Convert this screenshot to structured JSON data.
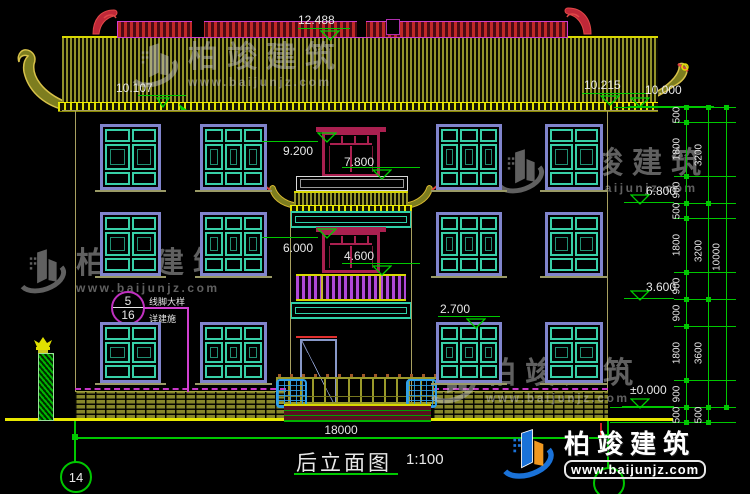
{
  "drawing": {
    "title": "后立面图",
    "scale": "1:100",
    "grid_left_label": "14",
    "bottom_dim": "18000"
  },
  "levels": {
    "ridge": "12.488",
    "left_roof": "10.107",
    "right_eave_tip": "10.215",
    "eave": "10.000",
    "tower_top_door_head": "9.200",
    "tower_top_door_sill": "7.800",
    "third_floor_window_head": "6.800",
    "tower_mid_door_head": "6.000",
    "tower_mid_door_sill": "4.600",
    "second_floor": "3.600",
    "first_floor_window_head": "2.700",
    "ground": "±0.000"
  },
  "right_dims": {
    "chain_inner": [
      "500",
      "1800",
      "900",
      "500",
      "1800",
      "900",
      "900",
      "1800",
      "900",
      "500"
    ],
    "chain_middle": [
      "3200",
      "3200",
      "3600",
      "500"
    ],
    "chain_outer": [
      "10000"
    ]
  },
  "callout": {
    "number": "5",
    "sheet": "16",
    "text_top": "线脚大样",
    "text_bottom": "详建施"
  },
  "watermark": {
    "name": "柏竣建筑",
    "url": "www.baijunjz.com"
  },
  "colors": {
    "dimension_green": "#00c800",
    "annotation_white": "#e8e8e8",
    "roof_tile_olive": "#93932a",
    "ridge_magenta": "#cf3ccf",
    "ridge_red": "#c02828",
    "window_frame_blue": "#8084cc",
    "window_teal": "#38d0a8",
    "door_maroon": "#aa2050",
    "railing_magenta": "#b048d8",
    "highlight_yellow": "#e0e000",
    "brand_blue": "#1a72d8",
    "brand_orange": "#f09820"
  }
}
